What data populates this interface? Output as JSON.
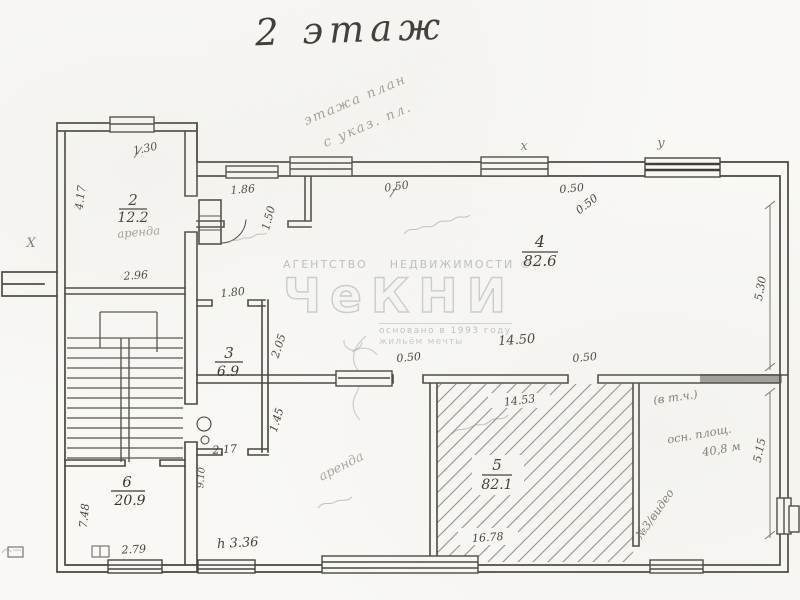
{
  "title": "2 этаж",
  "watermark": {
    "agency": "АГЕНТСТВО    НЕДВИЖИМОСТИ ®",
    "logo": "ЧеКНИ",
    "founded": "основано в 1993 году",
    "tagline": "жильём мечты"
  },
  "top_note": {
    "line1": "этажа план",
    "line2": "с указ. пл."
  },
  "rooms": {
    "r2": {
      "num": "2",
      "area": "12.2",
      "note": "аренда"
    },
    "r3": {
      "num": "3",
      "area": "6.9"
    },
    "r4": {
      "num": "4",
      "area": "82.6"
    },
    "r5": {
      "num": "5",
      "area": "82.1"
    },
    "r6": {
      "num": "6",
      "area": "20.9"
    }
  },
  "dims": {
    "room2_left": "4.17",
    "room2_top": "1.30",
    "room2_bottom": "2.96",
    "partition_top": "1.86",
    "partition_right": "1.50",
    "room3_top": "1.80",
    "room3_right_upper": "2.05",
    "room3_right_lower": "1.45",
    "room3_bottom": "2.17",
    "lower_left_side": "9.10",
    "room6_left": "7.48",
    "room6_bottom": "2.79",
    "ceiling_height": "h 3.36",
    "lower_bottom": "16.78",
    "room5_top": "14.53",
    "mid_wall": "14.50",
    "door_mid_left": "0.50",
    "door_mid_right": "0.50",
    "top_wall_left": "0.50",
    "top_wall_right_a": "0.50",
    "top_wall_right_b": "0.50",
    "right_upper": "5.30",
    "right_lower": "5.15"
  },
  "annotations": {
    "lower_left_note": "аренда",
    "right_note1": "(в т.ч.)",
    "right_note2": "осн. площ.",
    "right_note3": "40,8 м",
    "right_note4": "№3/видео"
  },
  "marks": {
    "top_x": "х",
    "top_y": "у",
    "left_x": "Х"
  }
}
